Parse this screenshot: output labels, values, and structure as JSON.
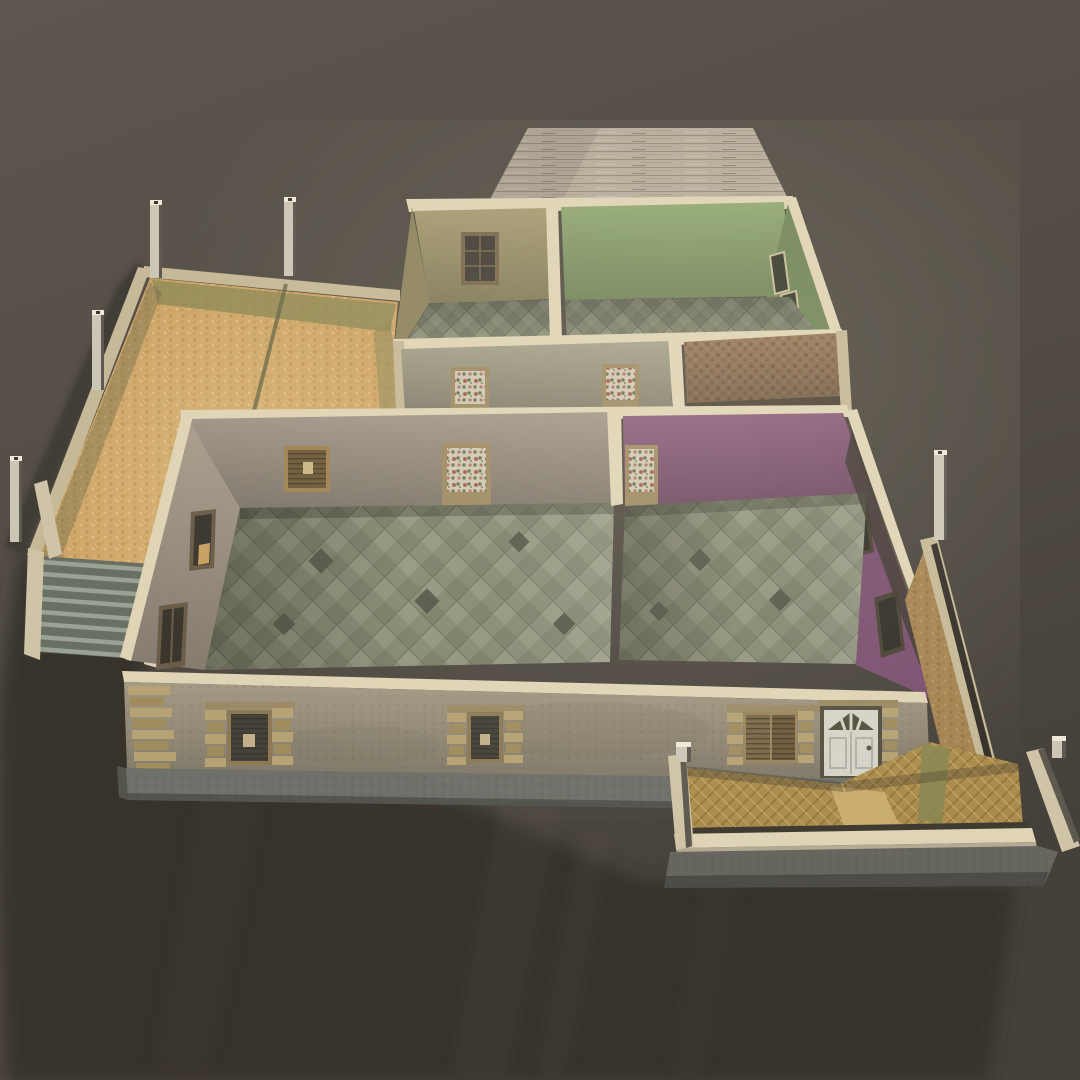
{
  "scene": {
    "title": "3D render of a roofless single-story house model (dollhouse cutaway floor plan)",
    "view": "steep top-down three-quarter perspective, light from upper right, long soft shadow cast to lower left",
    "rooms": [
      {
        "id": "room-khaki",
        "wall_color": "#a89d74",
        "floor": "small diamond tiles",
        "features": [
          "back-wall window"
        ]
      },
      {
        "id": "room-green",
        "wall_color": "#93a974",
        "floor": "small diamond tiles",
        "features": [
          "two windows on right wall"
        ]
      },
      {
        "id": "hallway",
        "wall_color": "#a7a28c",
        "floor": "diamond tiles",
        "features": [
          "floral-glass door left",
          "floral-glass door right"
        ]
      },
      {
        "id": "room-wallpaper",
        "wall_color": "#997a5c",
        "floor": "dark shadowed floor",
        "features": [
          "patterned brown wallpaper"
        ]
      },
      {
        "id": "living-room",
        "wall_color": "#a3988a",
        "floor": "large diamond tiles",
        "features": [
          "floral-glass door",
          "wooden slat vent window",
          "two windows in left wall"
        ]
      },
      {
        "id": "room-purple",
        "wall_color": "#8d5f7d",
        "floor": "large diamond tiles",
        "features": [
          "floral-glass door",
          "two shuttered windows on right wall"
        ]
      }
    ],
    "exterior": {
      "wood_deck": "plank deck slab behind the back rooms",
      "facade": [
        "brick corner quoins",
        "shuttered window with brick surround (left)",
        "shuttered window with brick surround (center)",
        "slatted shutter window (right)",
        "white paneled front door with fanlight"
      ],
      "left_yard": {
        "ground": "sandy straw texture with olive band and seam line",
        "fence_posts": 4,
        "stairs_steps": 8
      },
      "front_porch": {
        "ground": "woven tan tiles with lighter walkway",
        "low_walls": "cream capped walls on concrete base",
        "posts": 2
      },
      "right_side_yard": {
        "ground": "sandy strip",
        "posts": 1
      }
    }
  },
  "palette": {
    "background_top": "#5d564e",
    "background_bottom": "#45403a",
    "shadow": "#34302b",
    "cap_cream": "#e0d4b6",
    "cap_cream_dim": "#c6b998",
    "deck_wood": "#b5ab9a",
    "wall_khaki": "#a89d74",
    "wall_khaki_shade": "#8f855f",
    "wall_green": "#93a974",
    "wall_green_shade": "#73885a",
    "wall_hall": "#a7a28c",
    "wall_brown": "#997a5c",
    "wall_taupe": "#a3988a",
    "wall_taupe_light": "#ab9e8e",
    "wall_purple": "#8d5f7d",
    "wall_purple_shade": "#7b5070",
    "facade_stucco": "#a49a85",
    "plinth_concrete": "#70706a",
    "porch_base_concrete": "#67665e",
    "sand": "#cba164",
    "sand_olive": "#8e8956",
    "tile_floor": "#878b74",
    "dark_floor": "#4f4639",
    "porch_tile": "#ab8c4e",
    "porch_path": "#cdb070",
    "post_metal": "#ccc6b7",
    "door_white": "#d6d3c9",
    "window_dark": "#3f3b31",
    "quoin_brick": "#b6a274",
    "stair_concrete": "#6a6f63"
  }
}
